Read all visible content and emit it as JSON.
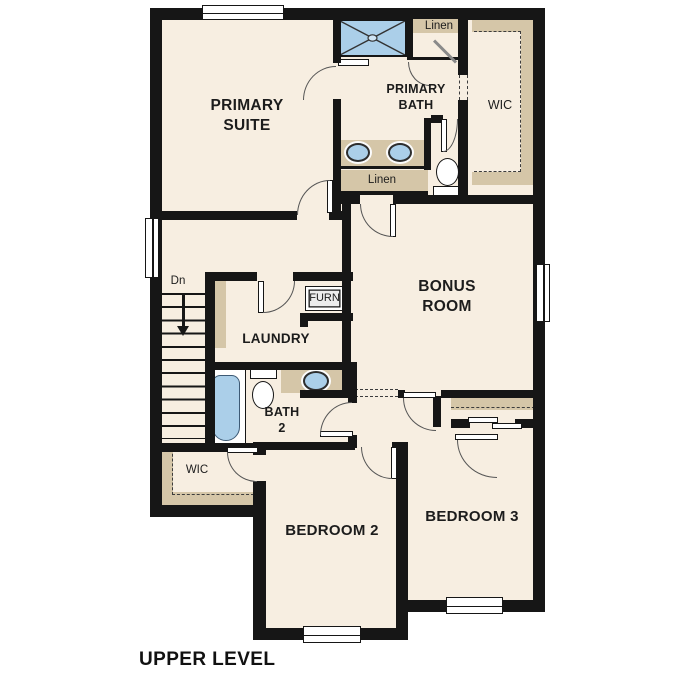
{
  "plan": {
    "title": "UPPER LEVEL",
    "rooms": {
      "primary_suite": {
        "label": "PRIMARY SUITE"
      },
      "primary_bath": {
        "label": "PRIMARY BATH"
      },
      "bonus_room": {
        "label": "BONUS ROOM"
      },
      "laundry": {
        "label": "LAUNDRY"
      },
      "bath_2": {
        "label": "BATH 2"
      },
      "bedroom_2": {
        "label": "BEDROOM 2"
      },
      "bedroom_3": {
        "label": "BEDROOM 3"
      },
      "wic_upper": {
        "label": "WIC"
      },
      "wic_lower": {
        "label": "WIC"
      }
    },
    "closets": {
      "linen_upper": {
        "label": "Linen"
      },
      "linen_hall": {
        "label": "Linen"
      }
    },
    "stairs": {
      "label": "Dn"
    },
    "utility": {
      "furnace": {
        "label": "FURN"
      }
    },
    "colors": {
      "wall": "#161616",
      "floor": "#f7eee1",
      "shelf_tan": "#d5c6a8",
      "fixture_blue": "#abcfe9",
      "background": "#ffffff"
    }
  }
}
